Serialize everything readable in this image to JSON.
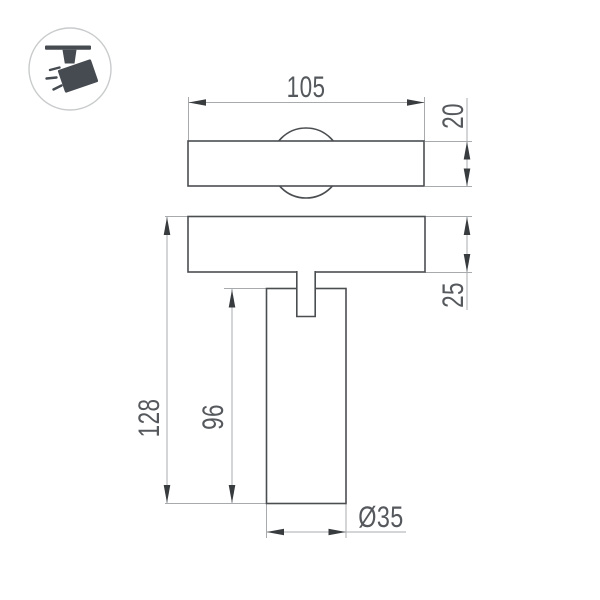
{
  "drawing": {
    "type": "technical-dimension-drawing",
    "product": "track-mounted-spotlight",
    "dimensions": {
      "track_plate_width": "105",
      "track_plate_depth": "20",
      "track_plate_height": "25",
      "total_height": "128",
      "body_height": "96",
      "body_diameter": "Ø35"
    }
  },
  "colors": {
    "background": "#ffffff",
    "outline": "#4b4e51",
    "dimension_line": "#a8abad",
    "arrow": "#383c3f",
    "text": "#55585c",
    "icon_glyph": "#464b51",
    "icon_circle": "#c9cbcc"
  }
}
